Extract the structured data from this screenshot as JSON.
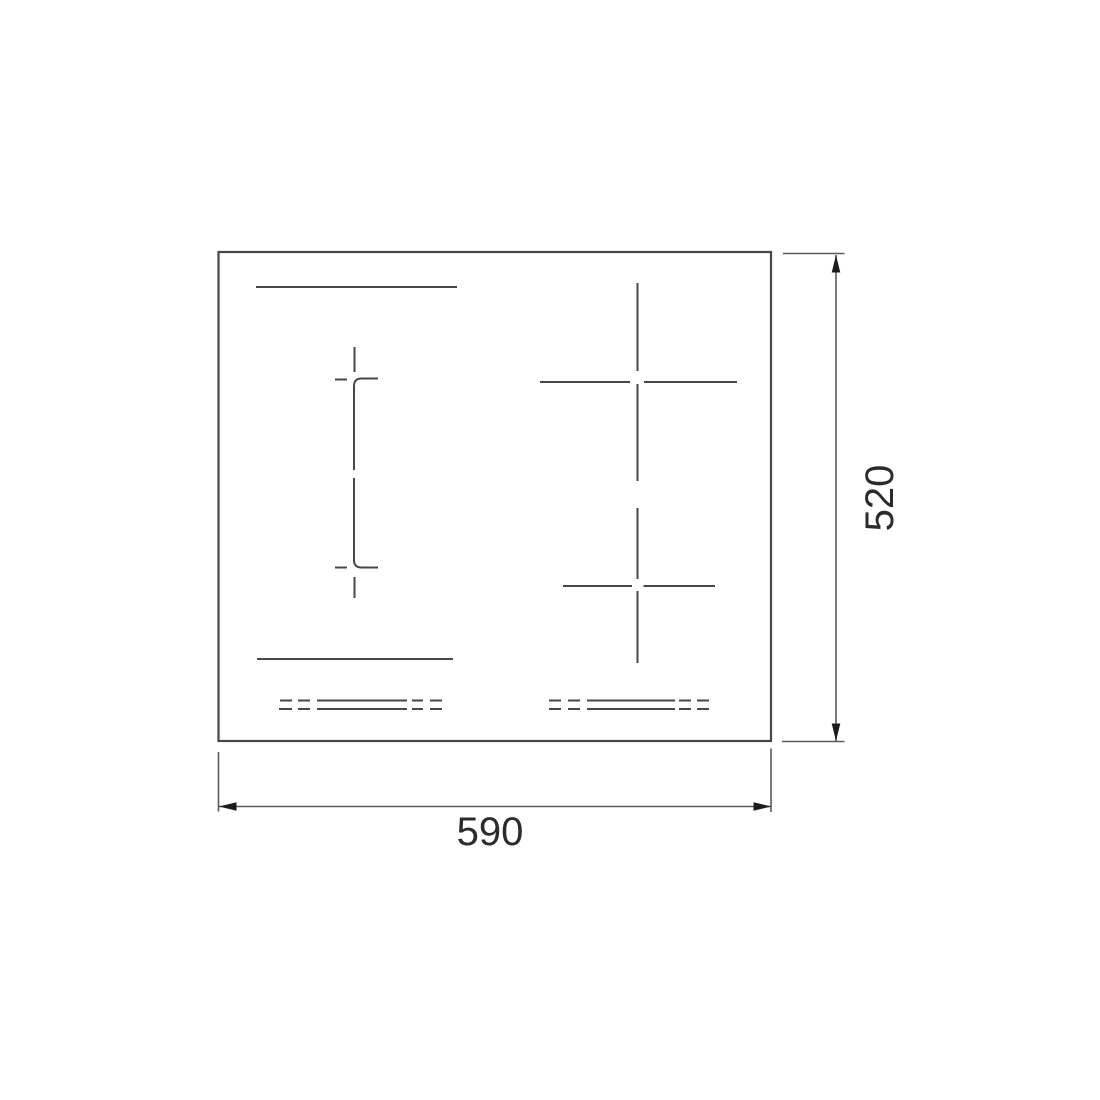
{
  "diagram": {
    "type": "technical-drawing",
    "subject": "induction-cooktop-top-view",
    "dimensions": {
      "width_label": "590",
      "height_label": "520"
    },
    "colors": {
      "background": "#ffffff",
      "line": "#474747",
      "dimline": "#5a5a5a",
      "arrow": "#1c1c1c",
      "text": "#2b2b2b"
    }
  }
}
